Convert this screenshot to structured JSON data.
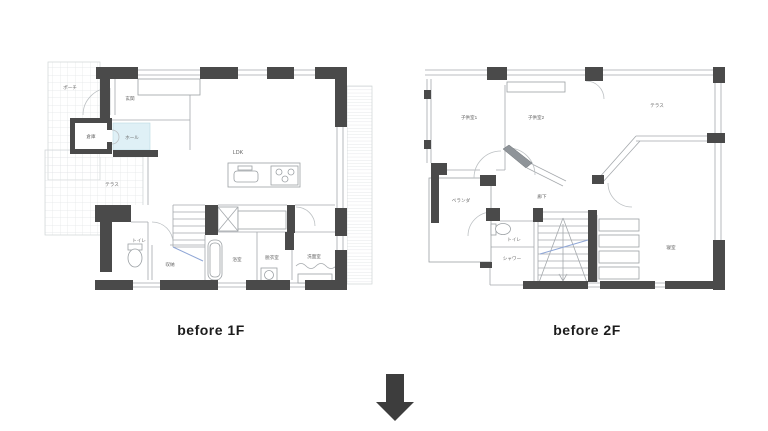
{
  "figure": {
    "description": "Before renovation floor plans, first and second floor, with downward arrow"
  },
  "plan1f": {
    "caption": "before 1F",
    "rooms": {
      "porch": "ポーチ",
      "entrance": "玄関",
      "storage_shed": "倉庫",
      "hall": "ホール",
      "terrace": "テラス",
      "ldk": "LDK",
      "toilet": "トイレ",
      "closet": "収納",
      "bath": "浴室",
      "dressing": "脱衣室",
      "washroom": "洗面室"
    }
  },
  "plan2f": {
    "caption": "before 2F",
    "rooms": {
      "kids1": "子供室1",
      "kids2": "子供室2",
      "terrace": "テラス",
      "veranda": "ベランダ",
      "corridor": "廊下",
      "toilet": "トイレ",
      "shower": "シャワー",
      "bedroom": "寝室"
    }
  },
  "colors": {
    "background": "#ffffff",
    "wall": "#4a4a4a",
    "thin_line": "#a5a9ad",
    "grid_line": "#e2e5e7",
    "hall_fill": "#dff0f6",
    "stair_rail_blue": "#8fa6d6",
    "arrow": "#3d3d3d",
    "room_label": "#666666",
    "caption_text": "#1c1c1c"
  }
}
